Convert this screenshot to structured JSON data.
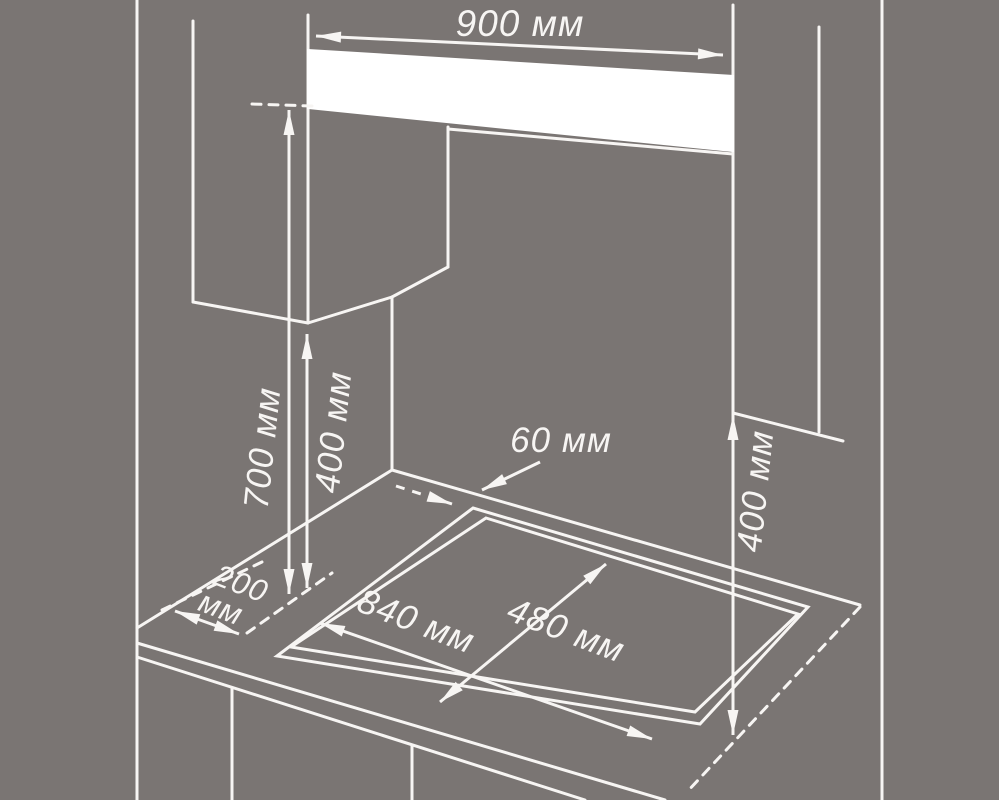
{
  "labels": {
    "hood_width": "900 мм",
    "hood_above_counter": "700 мм",
    "left_cabinet_above_counter": "400 мм",
    "rear_edge_offset": "60 мм",
    "side_offset_value": "200",
    "side_offset_unit": "мм",
    "cutout_width": "840 мм",
    "cutout_depth": "480 мм",
    "right_cabinet_above_counter": "400 мм"
  },
  "colors": {
    "background": "#7a7573",
    "line": "#f7f5f3",
    "panel": "#ffffff",
    "text": "#f7f5f3"
  }
}
